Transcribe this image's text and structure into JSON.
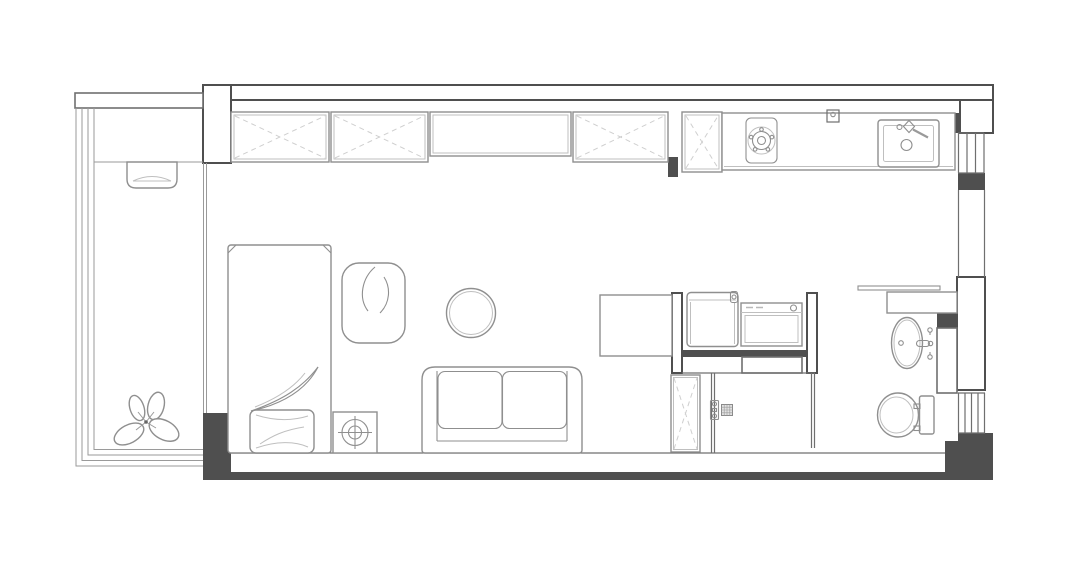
{
  "meta": {
    "type": "floor-plan",
    "description": "Top-down architectural floor plan of a studio apartment with balcony, wardrobe wall, kitchen, laundry niche, shower room and bathroom",
    "canvas": {
      "width": 1080,
      "height": 565
    }
  },
  "palette": {
    "background": "#ffffff",
    "wall_stroke": "#4f4f4f",
    "thin_stroke": "#6f6f6f",
    "furniture_stroke": "#8f8f8f",
    "light_stroke": "#bfbfbf",
    "dashed_stroke": "#cfcfcf"
  },
  "areas": {
    "balcony": {
      "items": [
        "ac-unit",
        "plant",
        "railing-window-lines"
      ]
    },
    "wardrobe_wall": {
      "items": [
        "wardrobe-section-1",
        "wardrobe-section-2",
        "open-shelf",
        "wardrobe-section-3"
      ]
    },
    "kitchen": {
      "items": [
        "fridge",
        "kitchen-counter",
        "gas-stove",
        "wall-outlet",
        "kitchen-sink"
      ]
    },
    "living_sleeping": {
      "items": [
        "single-bed",
        "duvet",
        "pillow",
        "lounge-chair",
        "side-table-lamp",
        "round-table",
        "loveseat-sofa",
        "desk"
      ]
    },
    "laundry_niche": {
      "items": [
        "washing-machine",
        "dryer"
      ]
    },
    "shower_room": {
      "items": [
        "shower-mixer",
        "shower-head"
      ]
    },
    "storage": {
      "items": [
        "tall-cabinet"
      ]
    },
    "bathroom": {
      "items": [
        "mirror-shelf",
        "vanity-counter",
        "wash-basin",
        "basin-faucet",
        "toilet"
      ]
    }
  },
  "windows": {
    "right_wall_count": 2,
    "balcony_glazing_lines": 4
  }
}
